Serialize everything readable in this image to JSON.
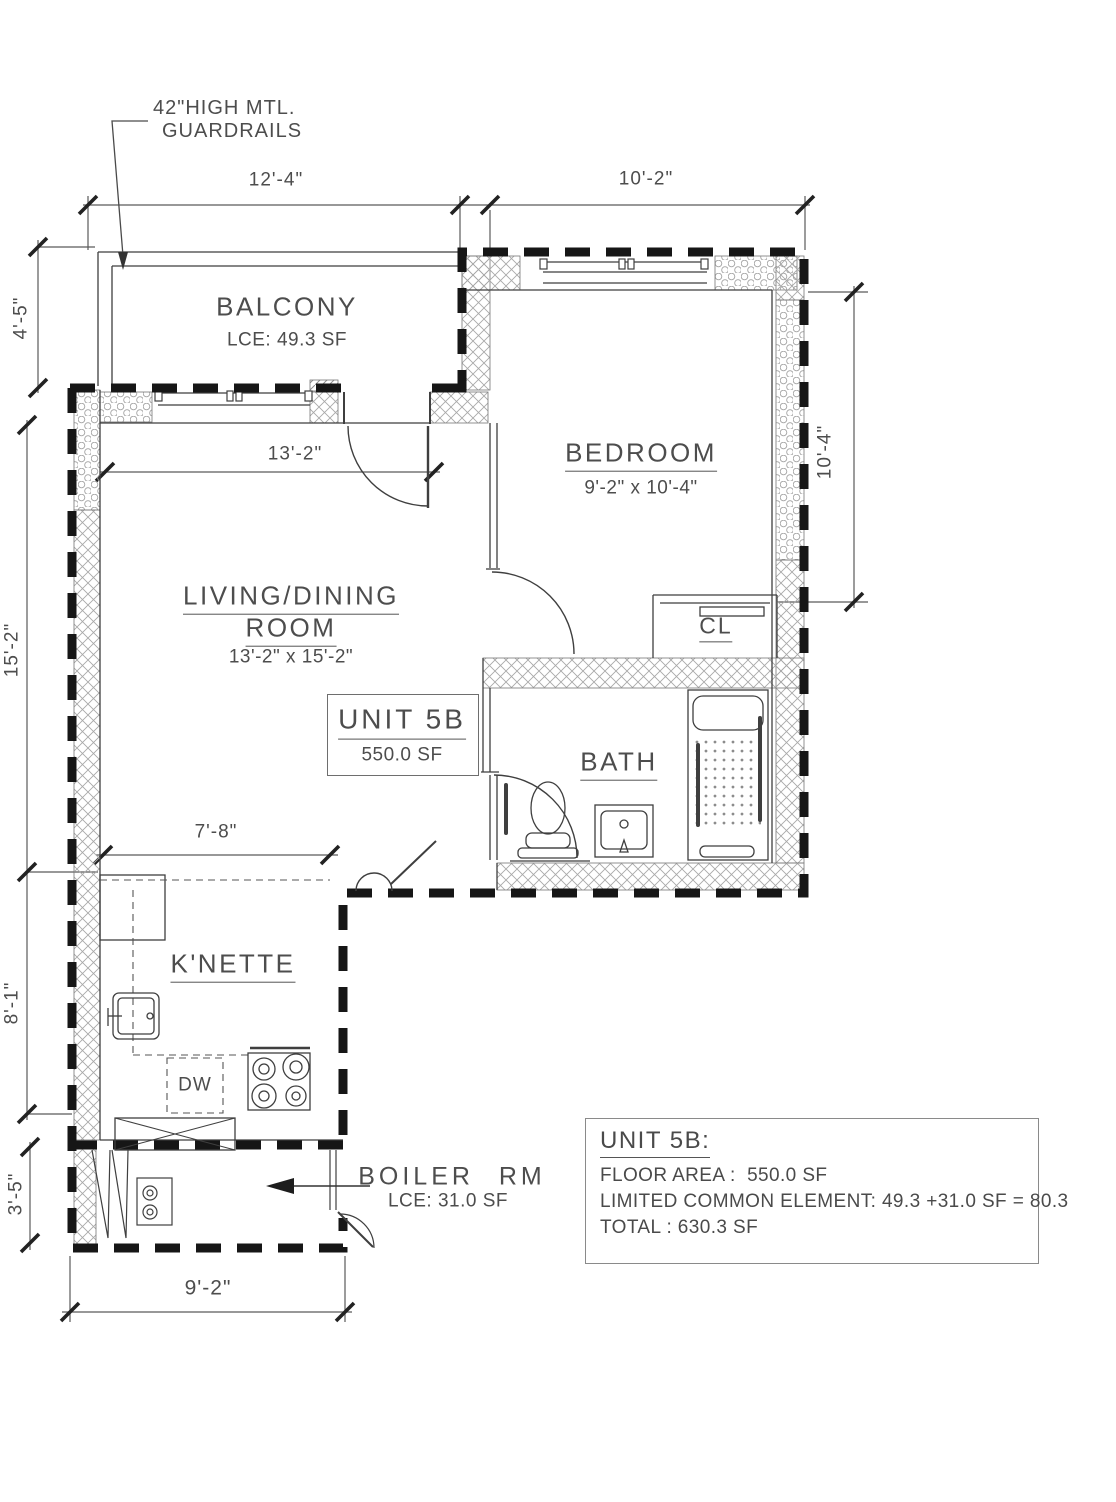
{
  "note": {
    "line1": "42\"HIGH MTL.",
    "line2": "GUARDRAILS"
  },
  "rooms": {
    "balcony": {
      "name": "BALCONY",
      "area": "LCE: 49.3 SF"
    },
    "bedroom": {
      "name": "BEDROOM",
      "size": "9'-2\" x 10'-4\""
    },
    "living": {
      "name1": "LIVING/DINING",
      "name2": "ROOM",
      "size": "13'-2\" x 15'-2\""
    },
    "unit": {
      "name": "UNIT 5B",
      "area": "550.0 SF"
    },
    "bath": {
      "name": "BATH"
    },
    "closet": {
      "name": "CL"
    },
    "kitchenette": {
      "name": "K'NETTE",
      "dishwasher": "DW"
    },
    "boiler": {
      "name": "BOILER RM",
      "area": "LCE: 31.0 SF"
    }
  },
  "dimensions": {
    "balcony_width": "12'-4\"",
    "bedroom_width_overall": "10'-2\"",
    "balcony_depth": "4'-5\"",
    "living_width": "13'-2\"",
    "living_depth": "15'-2\"",
    "bedroom_depth": "10'-4\"",
    "kitchen_width": "7'-8\"",
    "kitchen_depth": "8'-1\"",
    "boiler_depth": "3'-5\"",
    "boiler_width": "9'-2\""
  },
  "summary": {
    "title": "UNIT 5B:",
    "floor_area": "FLOOR AREA :  550.0 SF",
    "limited_common": "LIMITED COMMON ELEMENT: 49.3 +31.0 SF = 80.3",
    "total": "TOTAL : 630.3 SF"
  },
  "colors": {
    "ink": "#3f3f3f",
    "text": "#4a4a4a",
    "boundary": "#161616",
    "hatch": "#a5a5a5",
    "background": "#ffffff"
  }
}
